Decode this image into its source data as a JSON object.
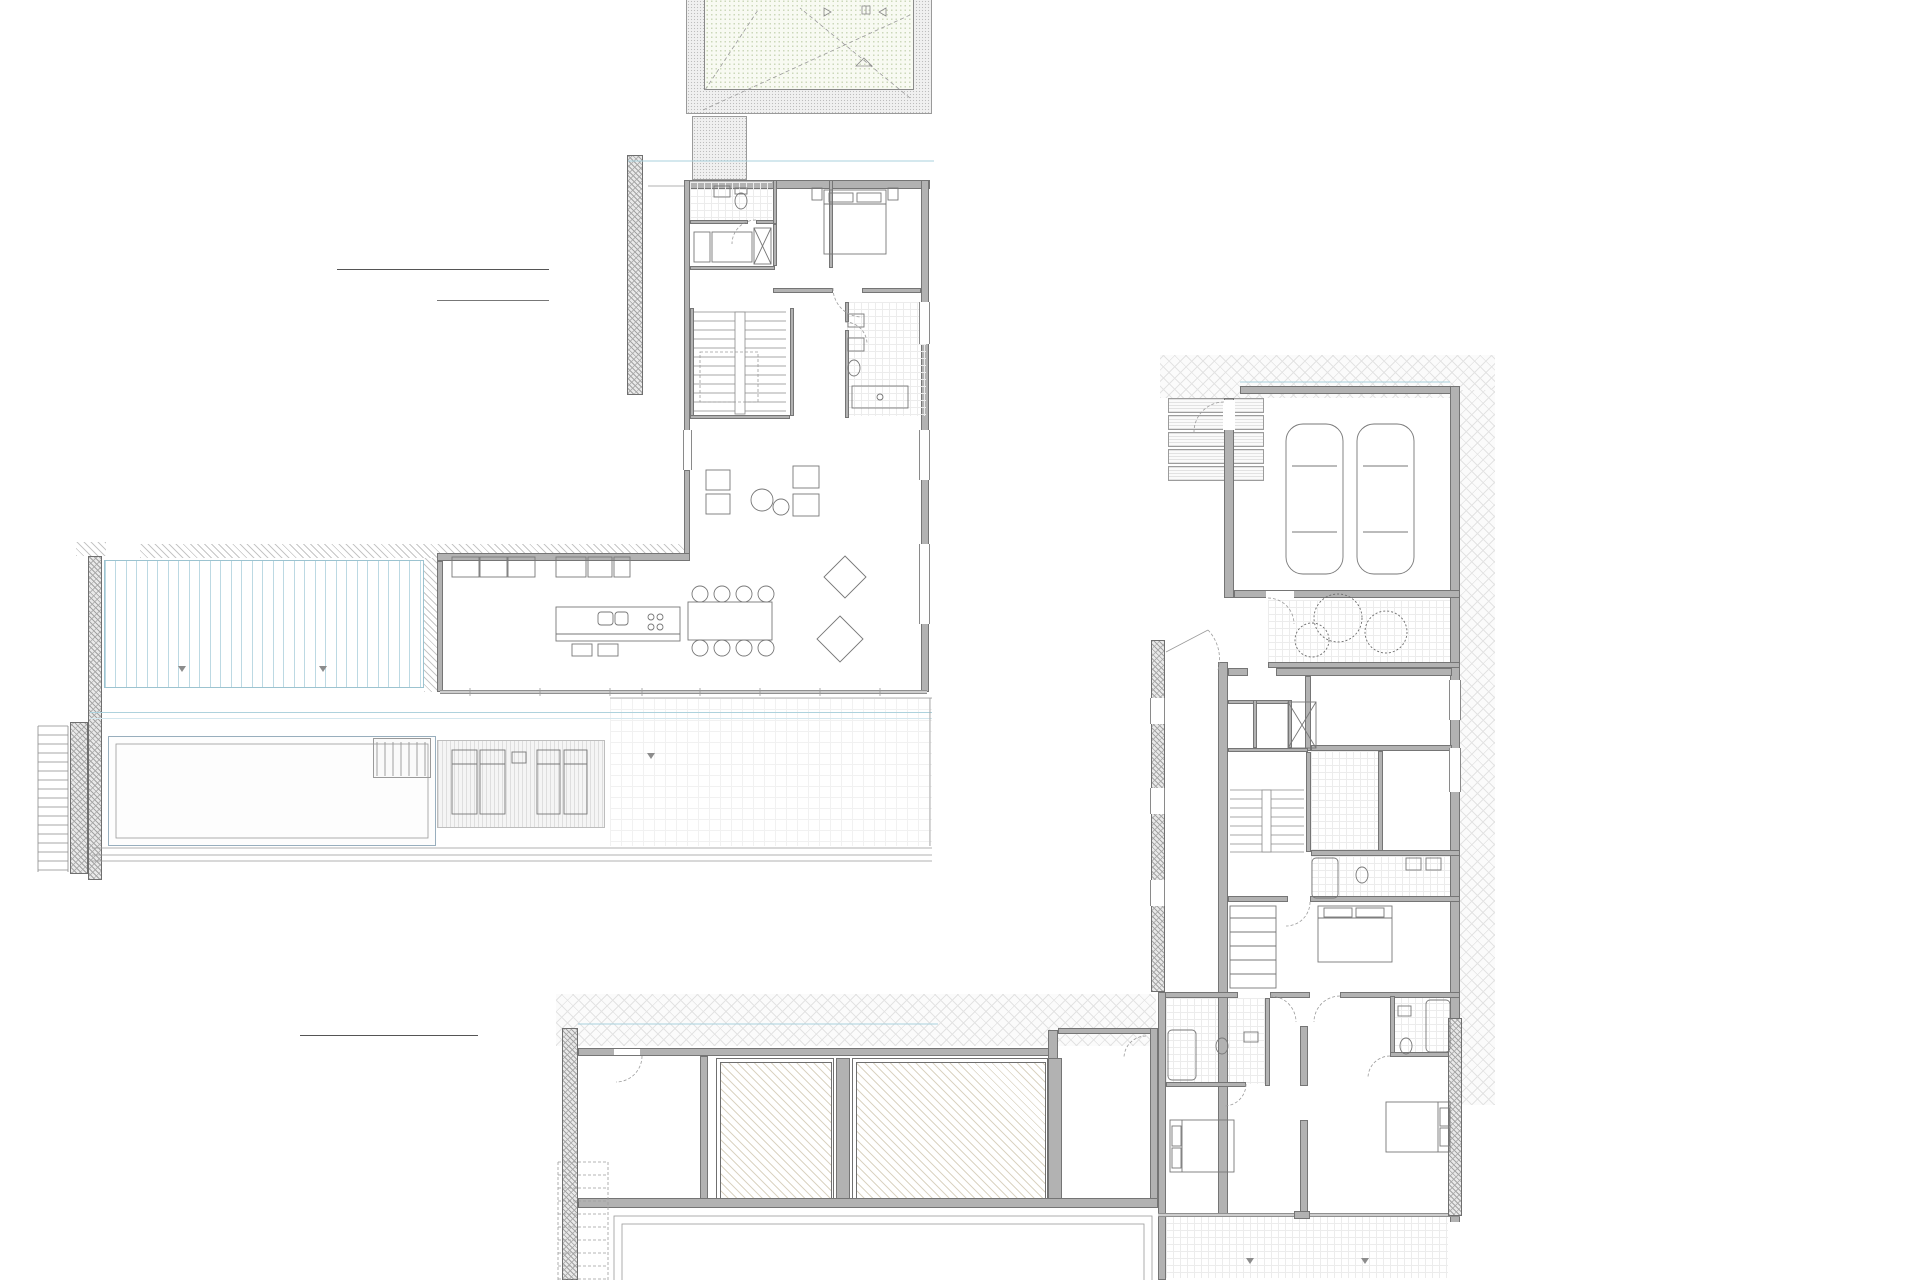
{
  "titles": {
    "upper": "PLANTA ALTA"
  },
  "tables": {
    "alta": {
      "header": "SUPERFICIES UTILES",
      "floor": "PLANTA ALTA",
      "rows": [
        {
          "n": "Aseo cortesia",
          "a": "2.96 m²"
        },
        {
          "n": "Paso",
          "a": "13.18 m²"
        },
        {
          "n": "Dormitorio 4 + vestidor",
          "a": "20.2 m²"
        },
        {
          "n": "Baño 4",
          "a": "7.56 m²"
        },
        {
          "n": "Salon-comedor",
          "a": "75.44 m²"
        },
        {
          "n": "Cocina",
          "a": "24.04 m²"
        },
        {
          "n": "Ascensor",
          "a": "2.28 m²"
        }
      ],
      "total": "145.66 m²"
    },
    "baja": {
      "header": "SUPERFICIES UTILES",
      "floor": "PLANTA BAJA",
      "rows": [
        {
          "n": "Garaje",
          "a": "42.16 m²"
        },
        {
          "n": "Paso",
          "a": "29.66 m²"
        },
        {
          "n": "Almacen",
          "a": "11.24 m²"
        },
        {
          "n": "Lavadero",
          "a": "6 m²"
        },
        {
          "n": "Cuarto tecnico",
          "a": "6.04 m²"
        },
        {
          "n": "Escalera int",
          "a": "7.92 m²"
        },
        {
          "n": "Dormitorio 1",
          "a": "18.76 m²"
        },
        {
          "n": "Baño 1",
          "a": "8.08 m²"
        },
        {
          "n": "Dormitorio 2",
          "a": "17.52 m²"
        },
        {
          "n": "Baño 2",
          "a": "5.52 m²"
        },
        {
          "n": "Dormitorio 3",
          "a": "21.36 m²"
        },
        {
          "n": "Baño 3",
          "a": "6 m²"
        },
        {
          "n": "Trastero",
          "a": "15.74 m²"
        },
        {
          "n": "Depuradora",
          "a": "16.37 m²"
        }
      ]
    }
  },
  "plan": {
    "labels": [
      {
        "t": "cubierta de cesped con\npendiente minima del 1.5%",
        "x": 800,
        "y": 10,
        "s": 5
      },
      {
        "t": "Sup. cub. 1\n33.05 m²",
        "x": 797,
        "y": 50,
        "s": 5,
        "c": "red"
      },
      {
        "t": "limahoya p=1.5%",
        "x": 806,
        "y": 74,
        "s": 4.5,
        "c": "#777777"
      },
      {
        "t": "limite parcela",
        "x": 681,
        "y": 14,
        "s": 4.5,
        "c": "#999999",
        "rot": 1
      },
      {
        "t": "Aseo\n2.96m2",
        "x": 737,
        "y": 205,
        "s": 4.8
      },
      {
        "t": "Vestidor",
        "x": 732,
        "y": 245,
        "s": 4.8
      },
      {
        "t": "Dormitorio 4\n20.2m2",
        "x": 845,
        "y": 226,
        "s": 4.8
      },
      {
        "t": "Paso\n13.18m2",
        "x": 707,
        "y": 286,
        "s": 4.8
      },
      {
        "t": "Baño 4\n7.56m2",
        "x": 892,
        "y": 392,
        "s": 4.8
      },
      {
        "t": "VIVIENDA A\n145.66m2",
        "x": 670,
        "y": 543,
        "s": 4.5
      },
      {
        "t": "Cocina\n24.04m2",
        "x": 490,
        "y": 616,
        "s": 4.8
      },
      {
        "t": "Salon-Comedor\n75.44m2",
        "x": 712,
        "y": 614,
        "s": 4.8
      },
      {
        "t": "PERGOLAS\n33.8m2",
        "x": 256,
        "y": 620,
        "s": 4.8,
        "ls": 1
      },
      {
        "t": "PISCINA\n38.50m2",
        "x": 230,
        "y": 780,
        "s": 4.8,
        "ls": 1
      },
      {
        "t": "TERRAZA\n58.3m2",
        "x": 728,
        "y": 780,
        "s": 4.8,
        "ls": 1
      },
      {
        "t": "CANALÓN",
        "x": 360,
        "y": 850,
        "s": 5,
        "ls": 2,
        "c": "#666666"
      },
      {
        "t": "GARAJE\n42.16m2",
        "x": 1352,
        "y": 412,
        "s": 4.8,
        "ls": 1
      },
      {
        "t": "JARDINERA\n11.0m2",
        "x": 1430,
        "y": 640,
        "s": 4.8
      },
      {
        "t": "VIVIENDA A\n212.37m2",
        "x": 1196,
        "y": 712,
        "s": 4.5
      },
      {
        "t": "Lavadero\n6m2",
        "x": 1262,
        "y": 724,
        "s": 4.5
      },
      {
        "t": "Almacen\n11.24m2",
        "x": 1373,
        "y": 698,
        "s": 4.8
      },
      {
        "t": "Paso\n29.66m2",
        "x": 1240,
        "y": 760,
        "s": 4.8
      },
      {
        "t": "Cuarto Tecnico\n6.04m2",
        "x": 1408,
        "y": 801,
        "s": 4.8
      },
      {
        "t": "Baño 1\n8.08m2",
        "x": 1324,
        "y": 862,
        "s": 4.8
      },
      {
        "t": "Escalera int\n7.92m2",
        "x": 1262,
        "y": 882,
        "s": 4.8
      },
      {
        "t": "Dormitorio 1\n18.76m2",
        "x": 1353,
        "y": 956,
        "s": 4.8
      },
      {
        "t": "Baño 3\n6m2",
        "x": 1186,
        "y": 1062,
        "s": 4.8
      },
      {
        "t": "Baño 2\n5.52m2",
        "x": 1434,
        "y": 1024,
        "s": 4.8
      },
      {
        "t": "Dormitorio 3\n21.36m2",
        "x": 1207,
        "y": 1140,
        "s": 4.8
      },
      {
        "t": "Dormitorio 2\n17.52m2",
        "x": 1412,
        "y": 1118,
        "s": 4.8
      },
      {
        "t": "TRASTERO\n15.74m2",
        "x": 1108,
        "y": 1136,
        "s": 4.8,
        "ls": 1
      },
      {
        "t": "DEPURADORA\n16.37m2",
        "x": 652,
        "y": 1115,
        "s": 4.8,
        "ls": 1
      },
      {
        "t": "DEPOSITO COMPENSADOR\n24.71m2",
        "x": 772,
        "y": 1122,
        "s": 4.3,
        "ls": 0.5
      },
      {
        "t": "DEPOSITO AGUAS\n30.87m2",
        "x": 928,
        "y": 1126,
        "s": 4.3,
        "ls": 0.5
      },
      {
        "t": "PORCHE\n29.0m2",
        "x": 1308,
        "y": 1268,
        "s": 4.8,
        "ls": 1
      },
      {
        "t": "VOLADIZO",
        "x": 855,
        "y": 1035,
        "s": 4.3,
        "c": "#777777"
      },
      {
        "t": "ACERA",
        "x": 570,
        "y": 1085,
        "s": 4.3,
        "c": "#777777"
      }
    ],
    "levels": [
      {
        "t": "75.20",
        "x": 670,
        "y": 557
      },
      {
        "t": "75.20",
        "x": 728,
        "y": 793
      },
      {
        "t": "74,60",
        "x": 525,
        "y": 792
      },
      {
        "t": "72.10",
        "x": 1340,
        "y": 366
      },
      {
        "t": "72.05",
        "x": 1194,
        "y": 488
      },
      {
        "t": "72.05",
        "x": 1195,
        "y": 622
      },
      {
        "t": "72.10",
        "x": 1196,
        "y": 725
      },
      {
        "t": "72.05",
        "x": 1481,
        "y": 1093
      },
      {
        "t": "72.05",
        "x": 579,
        "y": 1094
      }
    ]
  }
}
